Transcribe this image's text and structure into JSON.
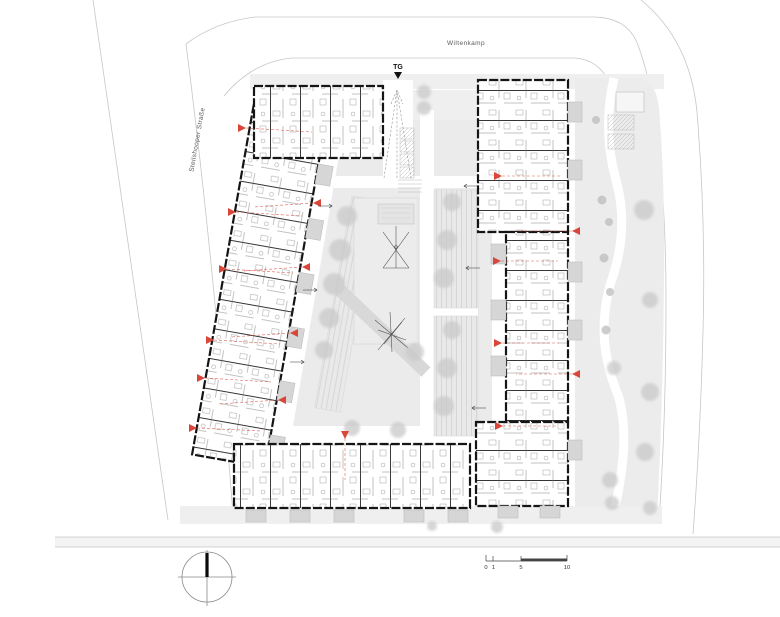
{
  "labels": {
    "street_top": "Wiltenkamp",
    "street_left": "Steilshooper Straße",
    "garage": "TG"
  },
  "scale_bar": {
    "tick0": "0",
    "tick1": "1",
    "tick5": "5",
    "tick10": "10"
  },
  "colors": {
    "accent_red": "#d9473a",
    "wall_black": "#151515",
    "site_gray": "#ebebeb",
    "tree_gray": "#c9c9c9",
    "street_line": "#c6c6c6"
  }
}
